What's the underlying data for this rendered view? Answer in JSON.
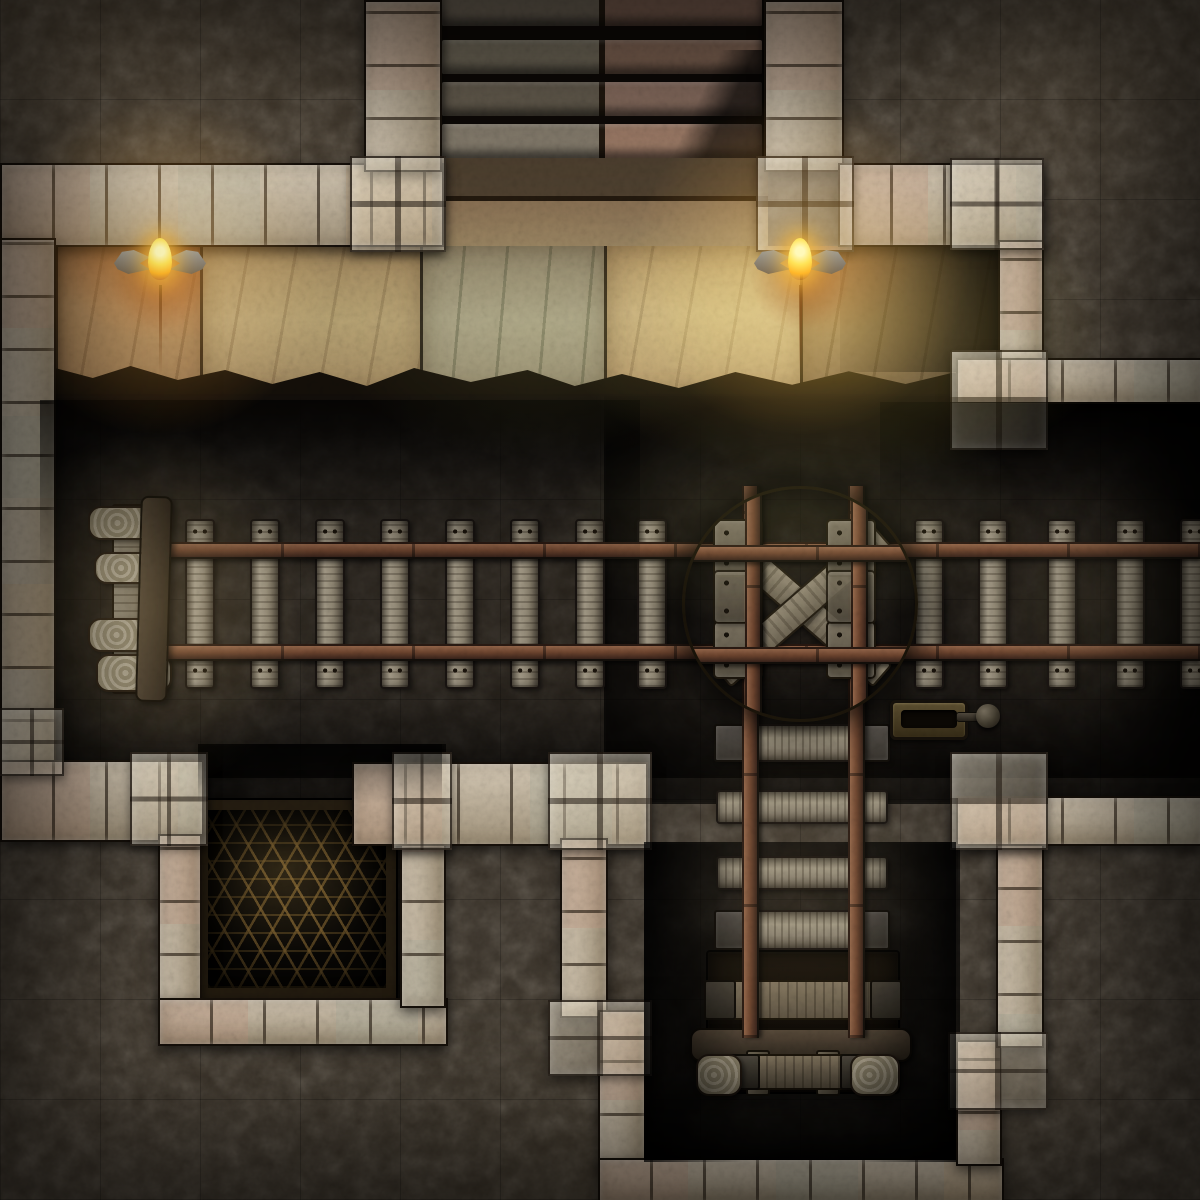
{
  "map": {
    "type": "dungeon-battle-map",
    "theme": "mine-cart-tunnels",
    "grid": {
      "columns": 12,
      "rows": 12,
      "cell_px": 100
    },
    "legend": {
      "stairs": "Stone staircase descending into the mine",
      "hallway": "Torch-lit stone hallway",
      "torch": "Wall torch with dragon-wing sconce",
      "main_track": "Mine cart track running east-west",
      "spur_track": "Mine cart track spur running south",
      "buffer_stop": "Timber buffer stop at west end of track",
      "turntable": "Wooden cart turntable with X brace and iron fittings",
      "lever": "Iron switch lever for the turntable",
      "mine_cart": "Wooden mine cart flatbed on the spur",
      "grate": "Iron floor grate in side alcove",
      "wall": "Dressed stone wall",
      "rock": "Rough cave rock"
    },
    "counts": {
      "stair_steps": 4,
      "wall_torches": 2,
      "main_track_ties": 13,
      "spur_track_ties": 4,
      "turntable_brackets": 8,
      "buffer_logs": 4
    },
    "palette": {
      "rock_base": "#3a332a",
      "rock_light": "#6a5a44",
      "wall_light": "#d8ccb8",
      "wall_mid": "#a2947c",
      "wall_seam": "#22180e",
      "floor_tan": "#b59d74",
      "floor_sage": "#a8a184",
      "floor_ember": "#a9825c",
      "rail_rust": "#6e452f",
      "tie_wood": "#a59c89",
      "plank_wood": "#8d8471",
      "metal_dark": "#575042",
      "grate_bar": "#806230",
      "torch_flame": "#ffda4a",
      "torch_glow": "#ff9d17"
    }
  }
}
